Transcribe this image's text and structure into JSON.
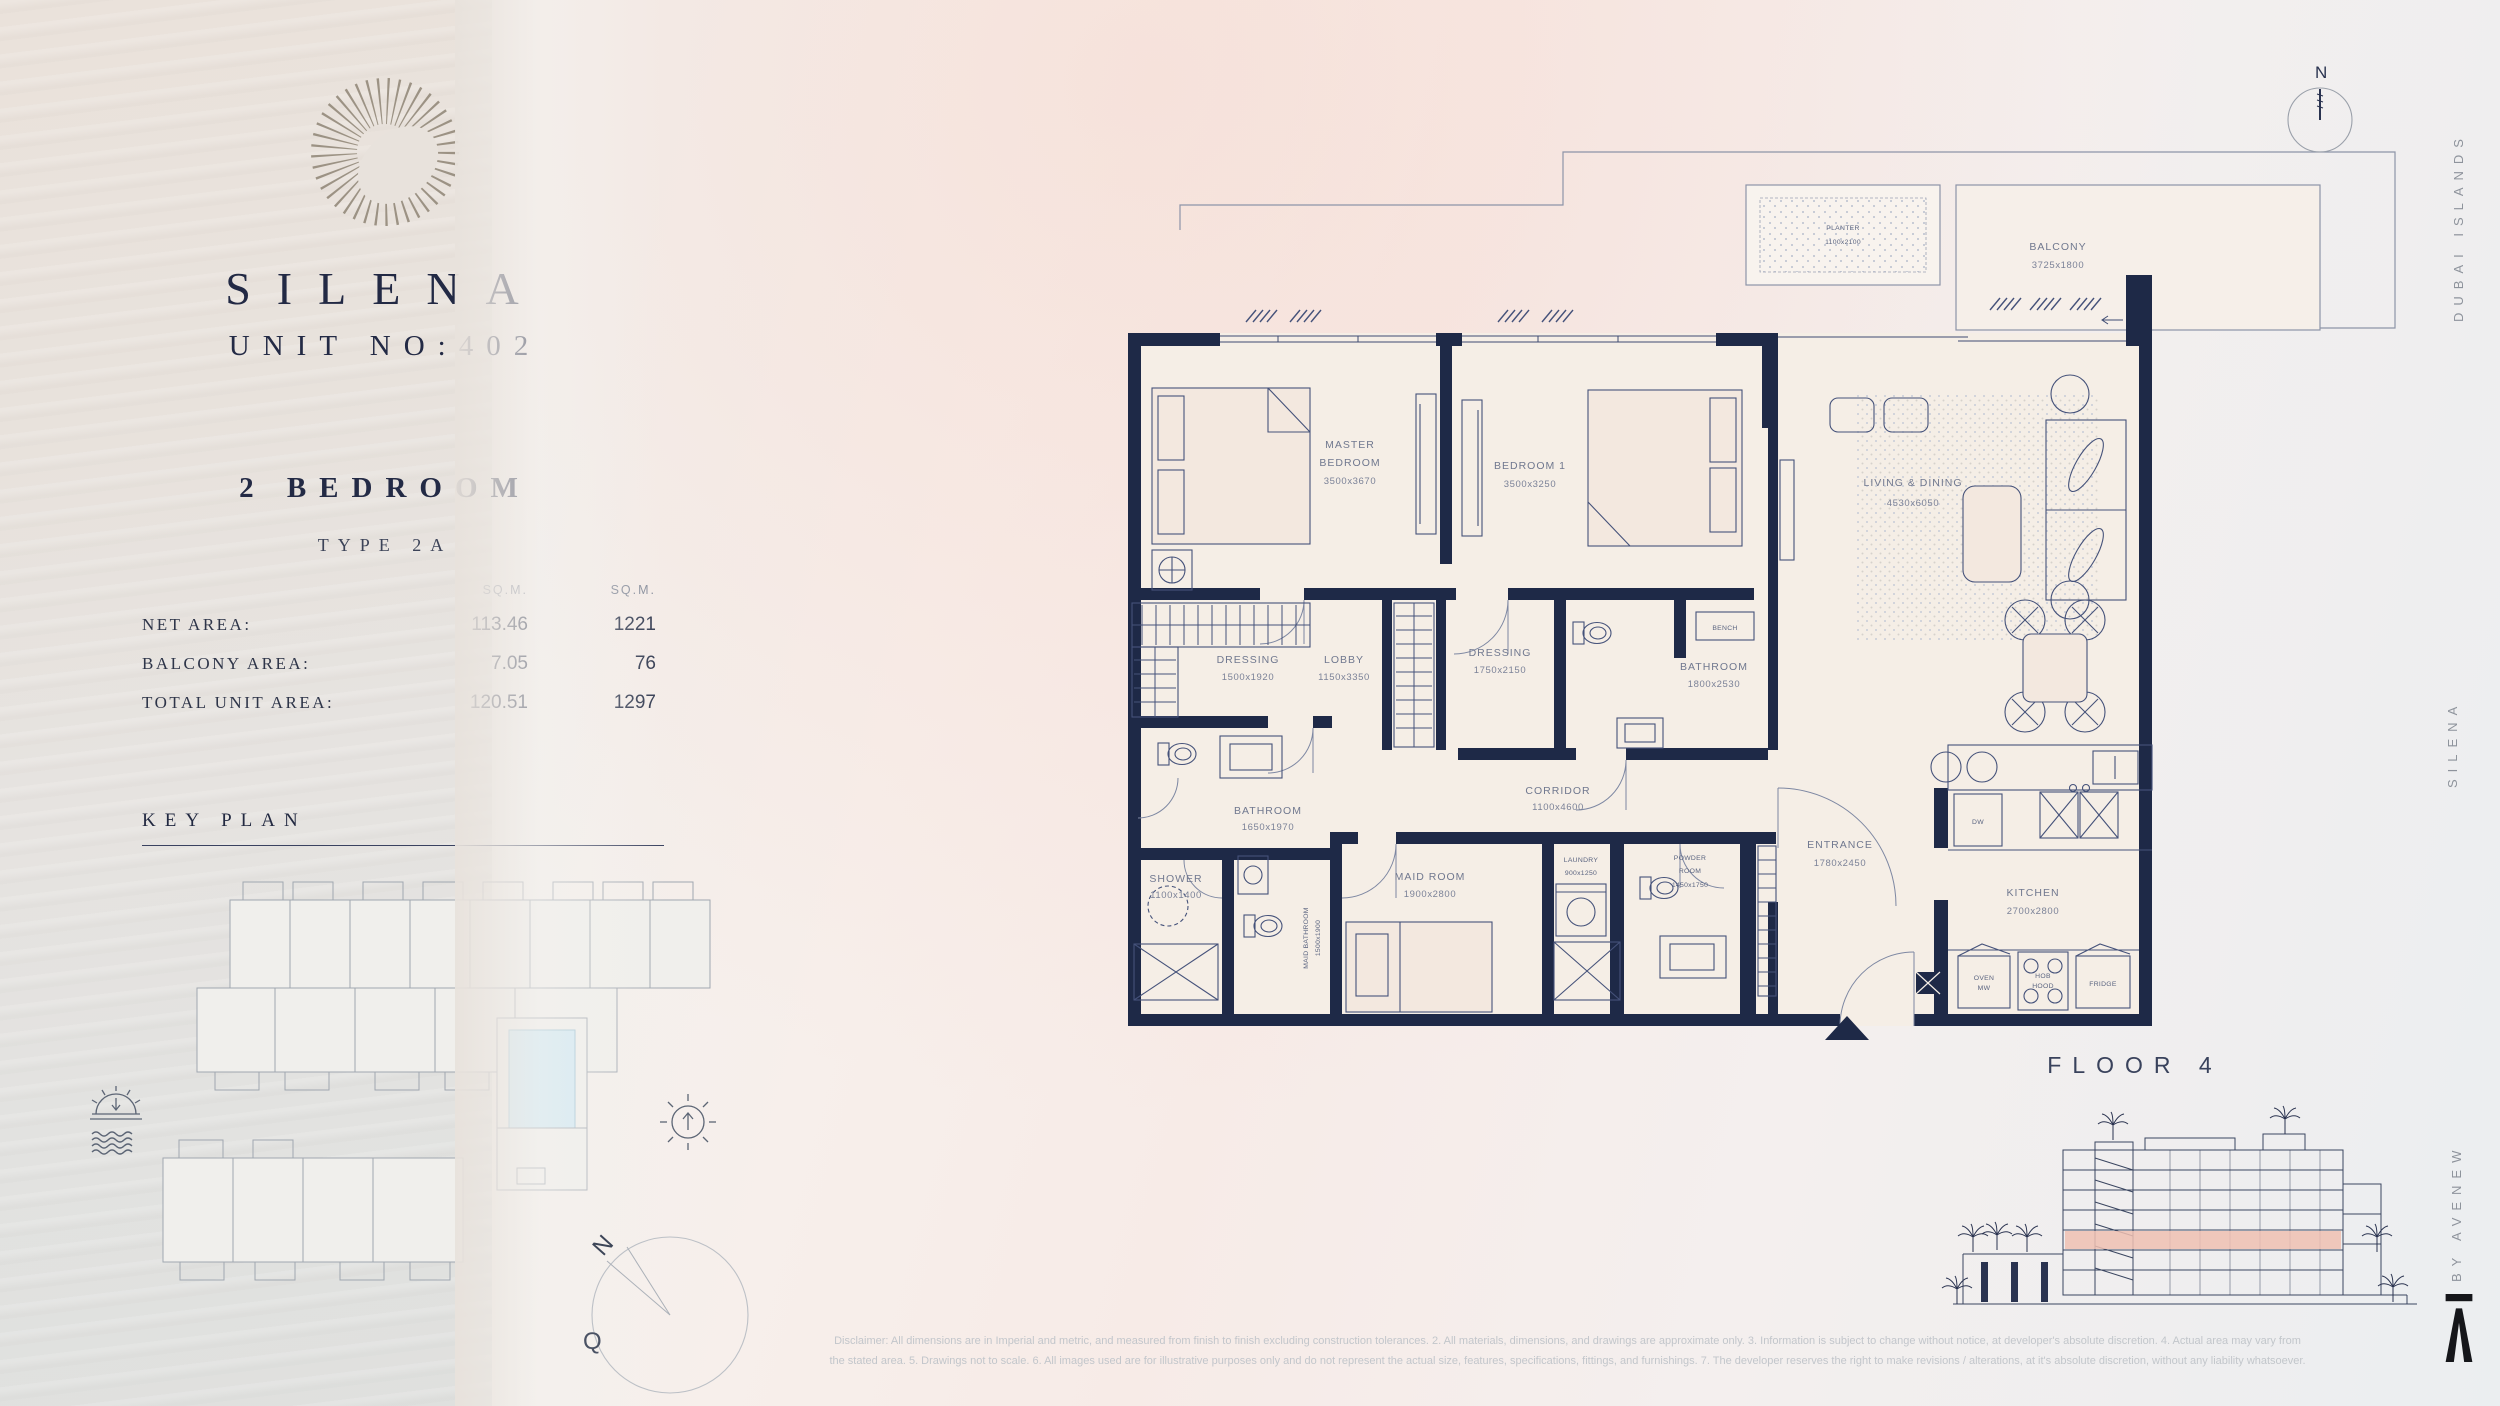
{
  "brand": {
    "name": "SILENA",
    "unit_no": "UNIT NO:402",
    "bedrooms": "2 BEDROOM",
    "type": "TYPE 2A"
  },
  "areas": {
    "col1_header": "SQ.M.",
    "col2_header": "SQ.M.",
    "rows": [
      {
        "label": "NET AREA:",
        "sqm": "113.46",
        "sqft": "1221"
      },
      {
        "label": "BALCONY AREA:",
        "sqm": "7.05",
        "sqft": "76"
      },
      {
        "label": "TOTAL UNIT AREA:",
        "sqm": "120.51",
        "sqft": "1297"
      }
    ]
  },
  "key_plan": {
    "title": "KEY PLAN",
    "compass_n": "N",
    "compass_q": "Q"
  },
  "side_labels": {
    "top": "DUBAI ISLANDS",
    "middle": "SILENA",
    "bottom": "BY AVENEW"
  },
  "compass": {
    "north": "N"
  },
  "floor": {
    "label": "FLOOR 4"
  },
  "plan": {
    "labels": {
      "master_l1": "MASTER",
      "master_l2": "BEDROOM",
      "master_dim": "3500x3670",
      "bed1_l1": "BEDROOM 1",
      "bed1_dim": "3500x3250",
      "living_l1": "LIVING & DINING",
      "living_dim": "4530x6050",
      "dressing1_l1": "DRESSING",
      "dressing1_dim": "1500x1920",
      "lobby_l1": "LOBBY",
      "lobby_dim": "1150x3350",
      "dressing2_l1": "DRESSING",
      "dressing2_dim": "1750x2150",
      "bath2_l1": "BATHROOM",
      "bath2_dim": "1800x2530",
      "bench": "BENCH",
      "corridor_l1": "CORRIDOR",
      "corridor_dim": "1100x4600",
      "bath1_l1": "BATHROOM",
      "bath1_dim": "1650x1970",
      "shower_l1": "SHOWER",
      "shower_dim": "1100x1400",
      "maidbath_l1": "MAID BATHROOM",
      "maidbath_dim": "1500x1900",
      "maid_l1": "MAID ROOM",
      "maid_dim": "1900x2800",
      "laundry_l1": "LAUNDRY",
      "laundry_dim": "900x1250",
      "powder_l1": "POWDER",
      "powder_l2": "ROOM",
      "powder_dim": "1450x1750",
      "entrance_l1": "ENTRANCE",
      "entrance_dim": "1780x2450",
      "kitchen_l1": "KITCHEN",
      "kitchen_dim": "2700x2800",
      "planter_l1": "PLANTER",
      "planter_dim": "1100x2100",
      "balcony_l1": "BALCONY",
      "balcony_dim": "3725x1800"
    },
    "appliances": {
      "dw": "DW",
      "oven_l1": "OVEN",
      "oven_l2": "MW",
      "hob_l1": "HOB",
      "hob_l2": "HOOD",
      "fridge": "FRIDGE"
    }
  },
  "disclaimer": {
    "line1": "Disclaimer: All dimensions are in Imperial and metric, and measured from finish to finish excluding construction tolerances. 2. All materials, dimensions, and drawings are approximate only. 3. Information is subject to change without notice, at developer's absolute discretion. 4. Actual area may vary from",
    "line2": "the stated area. 5. Drawings not to scale. 6. All images used are for illustrative purposes only and do not represent the actual size, features, specifications, fittings, and furnishings. 7. The developer reserves the right to make revisions / alterations, at it's absolute discretion, without any liability whatsoever."
  },
  "colors": {
    "wall_navy": "#1e2947",
    "highlight_unit": "#cfe9f4",
    "floor_band": "#eec0b2",
    "panel_beige": "#e8e2dc"
  }
}
